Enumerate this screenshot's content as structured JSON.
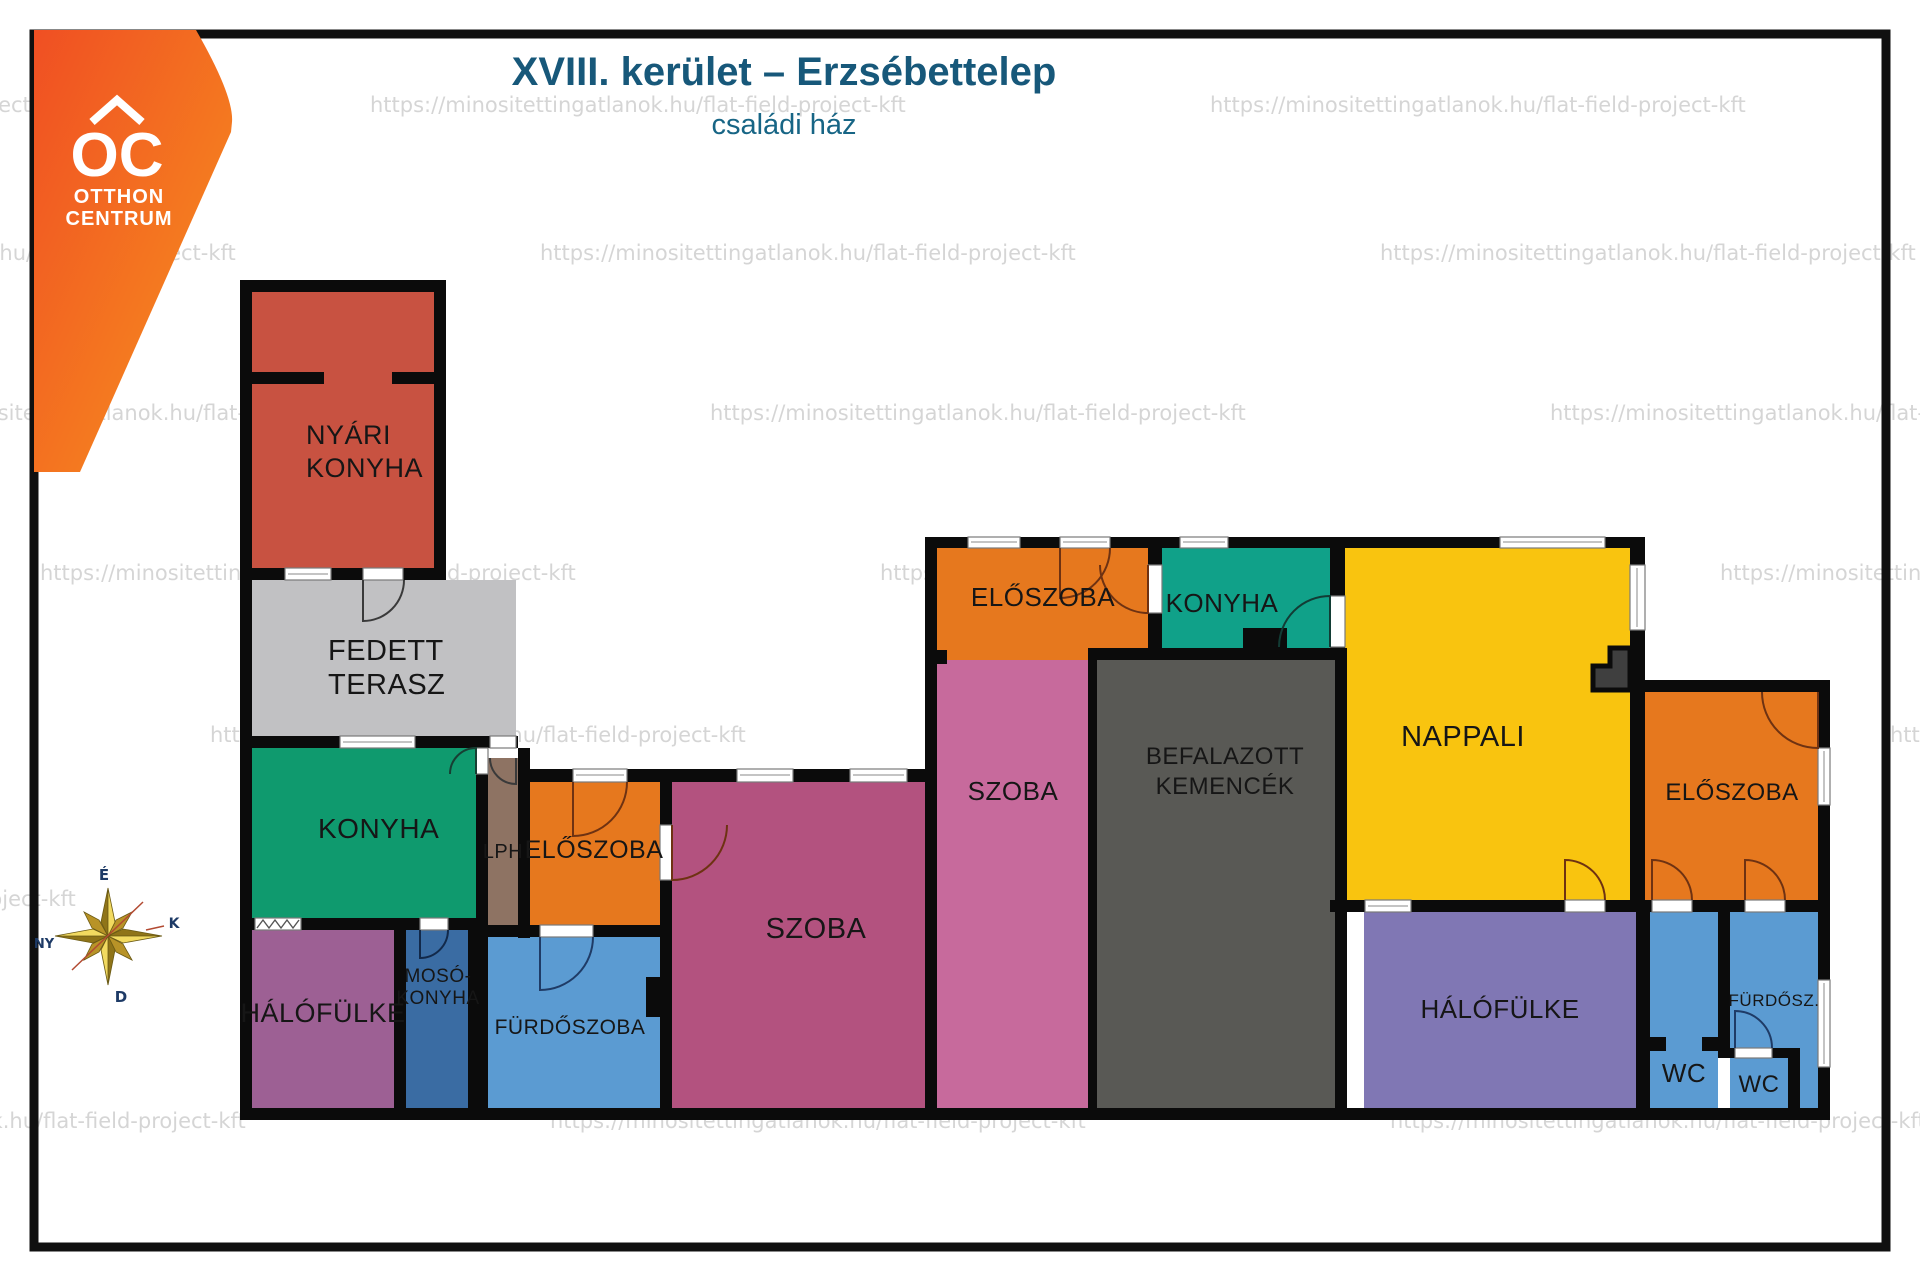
{
  "page": {
    "title": "XVIII. kerület – Erzsébettelep",
    "subtitle": "családi ház"
  },
  "logo": {
    "mark": "OC",
    "name_line1": "OTTHON",
    "name_line2": "CENTRUM",
    "brand_orange_dark": "#f04f23",
    "brand_orange_light": "#f7941e"
  },
  "watermark_text": "https://minositettingatlanok.hu/flat-field-project-kft",
  "compass": {
    "n": "É",
    "e": "K",
    "s": "D",
    "w": "NY"
  },
  "palette": {
    "wall": "#0b0b0b",
    "title_teal": "#17587a",
    "window_white": "#ffffff"
  },
  "rooms": [
    {
      "id": "nyari-konyha",
      "lines": [
        "NYÁRI",
        "KONYHA"
      ],
      "color": "#c85241"
    },
    {
      "id": "fedett-terasz",
      "lines": [
        "FEDETT",
        "TERASZ"
      ],
      "color": "#c1c1c3"
    },
    {
      "id": "konyha-left",
      "lines": [
        "KONYHA"
      ],
      "color": "#0f9a6e"
    },
    {
      "id": "lph",
      "lines": [
        "LPH"
      ],
      "color": "#8e7363"
    },
    {
      "id": "eloszoba-left",
      "lines": [
        "ELŐSZOBA"
      ],
      "color": "#e6781e"
    },
    {
      "id": "halofulke-left",
      "lines": [
        "HÁLÓFÜLKE"
      ],
      "color": "#9d6094"
    },
    {
      "id": "moso-konyha",
      "lines": [
        "MOSÓ-",
        "KONYHA"
      ],
      "color": "#3a6ca3"
    },
    {
      "id": "furdoszoba",
      "lines": [
        "FÜRDŐSZOBA"
      ],
      "color": "#5b9bd2"
    },
    {
      "id": "szoba-1",
      "lines": [
        "SZOBA"
      ],
      "color": "#b3527f"
    },
    {
      "id": "szoba-2",
      "lines": [
        "SZOBA"
      ],
      "color": "#c76a9c"
    },
    {
      "id": "eloszoba-top",
      "lines": [
        "ELŐSZOBA"
      ],
      "color": "#e6781e"
    },
    {
      "id": "konyha-teal",
      "lines": [
        "KONYHA"
      ],
      "color": "#10a189"
    },
    {
      "id": "befalazott-kemencek",
      "lines": [
        "BEFALAZOTT",
        "KEMENCÉK"
      ],
      "color": "#595955"
    },
    {
      "id": "nappali",
      "lines": [
        "NAPPALI"
      ],
      "color": "#f9c40f"
    },
    {
      "id": "eloszoba-right",
      "lines": [
        "ELŐSZOBA"
      ],
      "color": "#e6781e"
    },
    {
      "id": "halofulke-right",
      "lines": [
        "HÁLÓFÜLKE"
      ],
      "color": "#8077b4"
    },
    {
      "id": "wc-1",
      "lines": [
        "WC"
      ],
      "color": "#5b9bd2"
    },
    {
      "id": "wc-2",
      "lines": [
        "WC"
      ],
      "color": "#5b9bd2"
    },
    {
      "id": "furdosz",
      "lines": [
        "FÜRDŐSZ."
      ],
      "color": "#5b9bd2"
    }
  ]
}
